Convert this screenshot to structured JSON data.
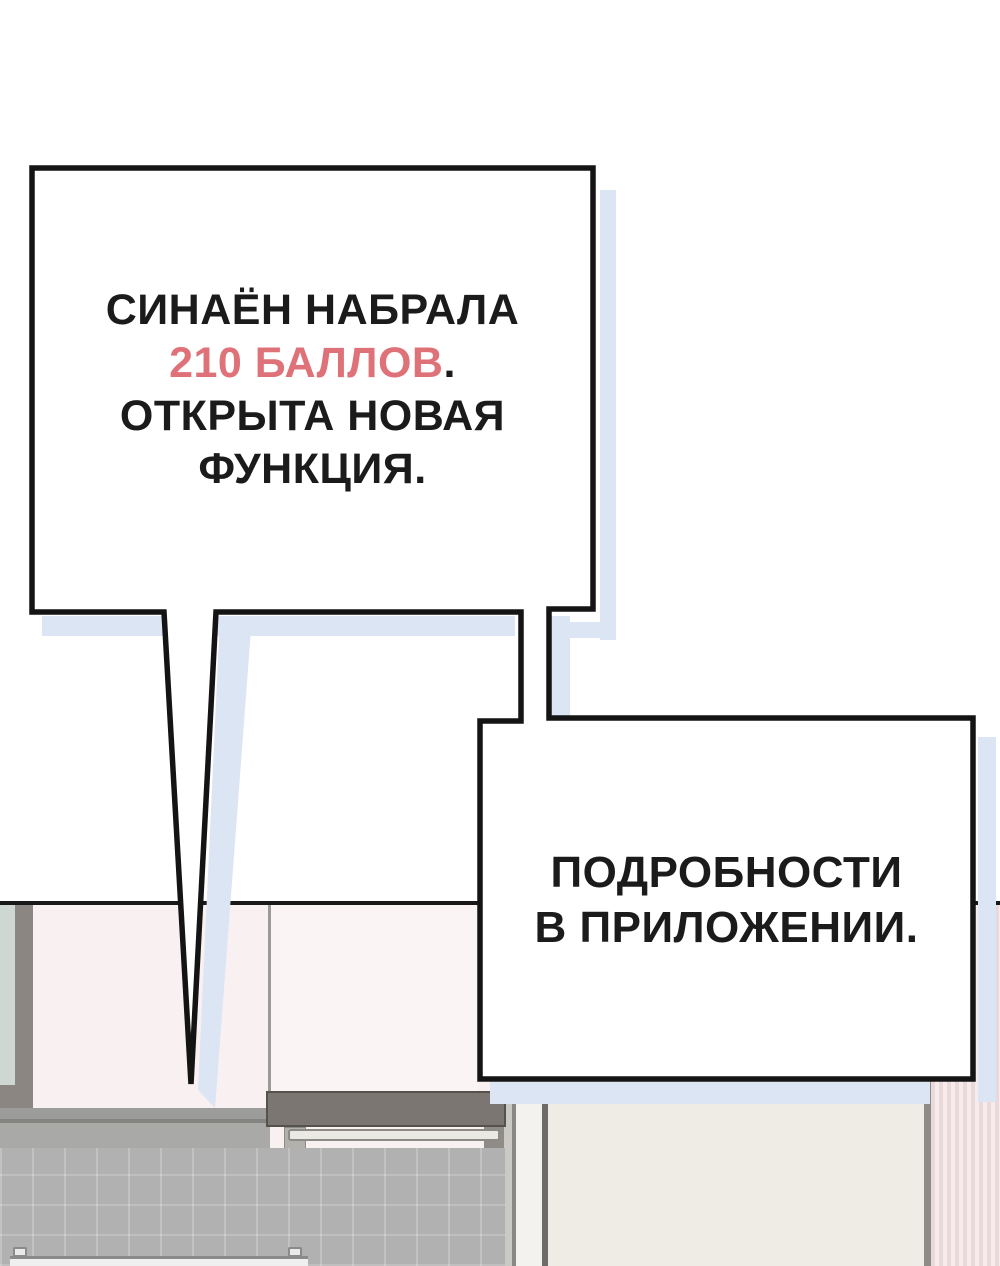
{
  "panel": {
    "kind": "webtoon-speech-panel"
  },
  "bubble1": {
    "line1": "СИНАЁН НАБРАЛА",
    "line2_red": "210 БАЛЛОВ",
    "line2_period": ".",
    "line3": "ОТКРЫТА НОВАЯ",
    "line4": "ФУНКЦИЯ."
  },
  "bubble2": {
    "line1": "ПОДРОБНОСТИ",
    "line2": "В ПРИЛОЖЕНИИ."
  },
  "colors": {
    "accent_red": "#df7279",
    "text": "#1b1b1b",
    "bubble_fill": "#ffffff",
    "bubble_border": "#141414",
    "shadow_blue": "#dbe5f3",
    "scene_line": "#191919",
    "wall_pink": "#f8f0f1",
    "tile_grey": "#b1b1b1",
    "fridge_beige": "#efece5"
  }
}
